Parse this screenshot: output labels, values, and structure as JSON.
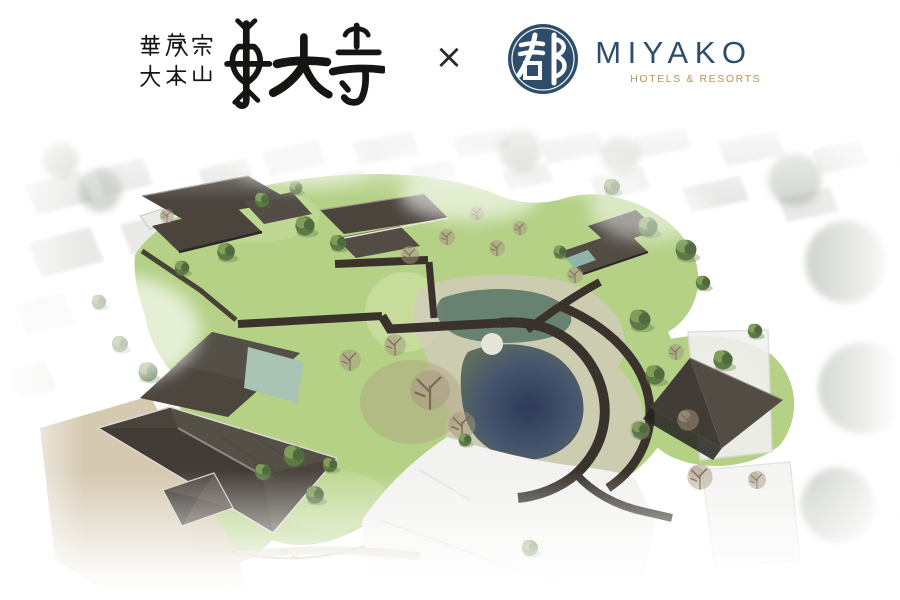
{
  "header": {
    "temple_logo": {
      "sect_line1": "華厳宗",
      "sect_line2": "大本山",
      "temple_name": "東大寺"
    },
    "separator": "×",
    "hotel_logo": {
      "emblem_character": "都",
      "brand_name": "MIYAKO",
      "tagline": "HOTELS & RESORTS"
    }
  },
  "colors": {
    "brand_navy": "#2e4d6b",
    "brand_gold": "#b5925a",
    "ink_black": "#171513",
    "roof_dark": "#4a443d",
    "roof_light_face": "#58524a",
    "lawn_green": "#b4d186",
    "lawn_light": "#c7dd9d",
    "pond_deep": "#34405e",
    "pond_moss": "#5d7a6a",
    "corridor_brown": "#3a332c",
    "stone_path": "#d2cbba",
    "courtyard_tan": "#d3c6ad",
    "tree_green": "#5c7a46",
    "tree_bare": "#a6957c",
    "backdrop_gray": "#d7d7d5"
  }
}
